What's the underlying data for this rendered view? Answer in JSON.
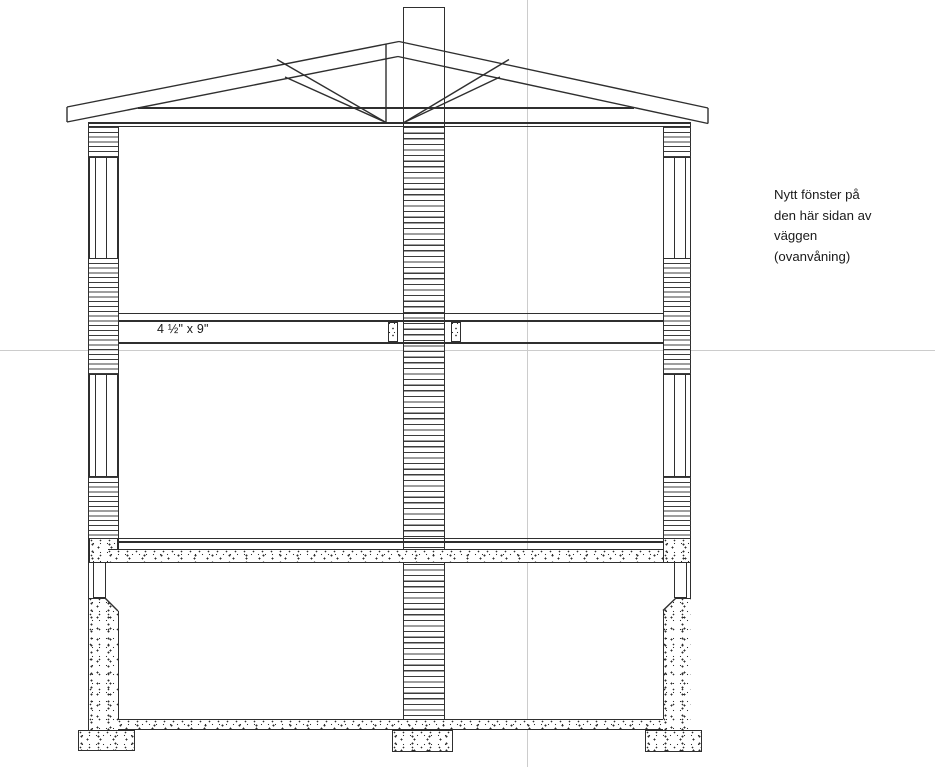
{
  "theme": {
    "line": "#2f2f2f",
    "hatch-line": "#3c3c3c",
    "centerline": "#cccccc",
    "canvas-bg": "#ffffff",
    "text": "#1a1a1a"
  },
  "drawing": {
    "type": "building cross-section",
    "beam_label": "4 ½\" x 9\"",
    "annotation_upper_window": {
      "lines": [
        "Nytt fönster på",
        "den här sidan av",
        "väggen",
        "(ovanvåning)"
      ]
    }
  }
}
